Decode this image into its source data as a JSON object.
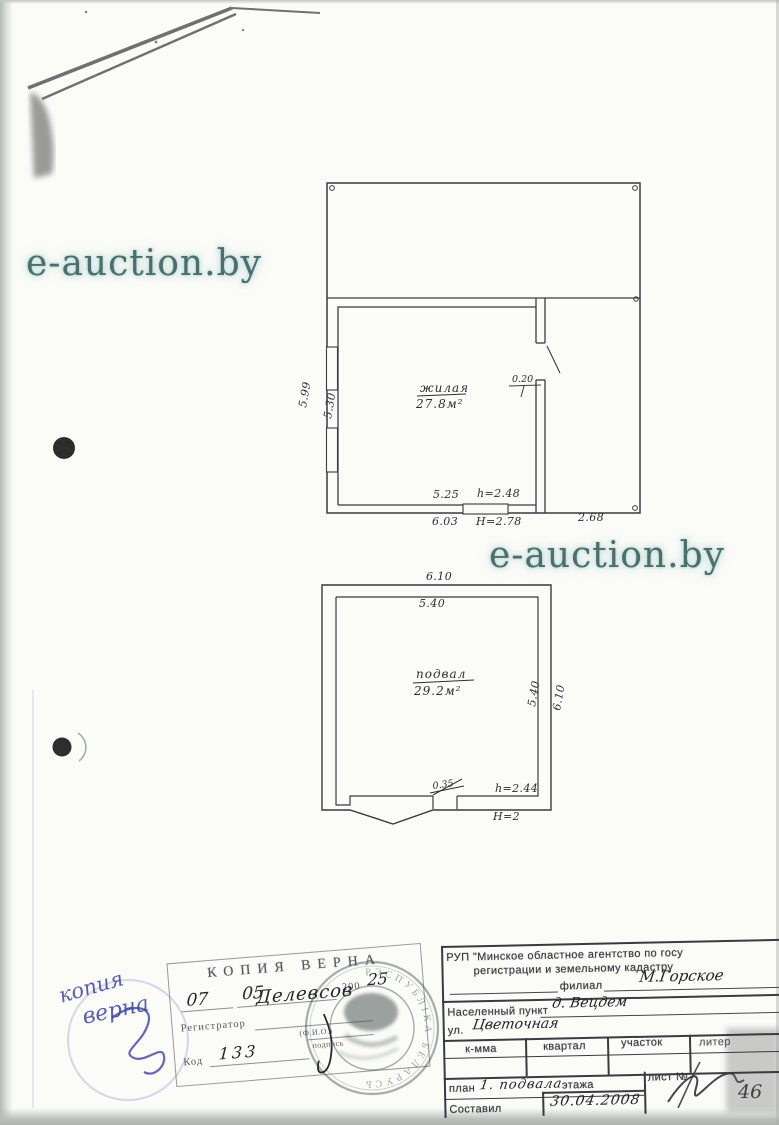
{
  "watermark": {
    "text": "e-auction.by"
  },
  "colors": {
    "watermark": "#4a6f6d",
    "ink": "#2d2d33",
    "blue_ink": "#3c43a9",
    "seal_gray": "#8f9a98"
  },
  "floor_plan_upper": {
    "room_label_line1": "жилая",
    "room_label_line2": "27.8м²",
    "dims": {
      "left_outer": "5.99",
      "left_inner": "5.30",
      "wall_right": "0.20",
      "inner_width": "5.25",
      "inner_height": "h=2.48",
      "outer_width": "6.03",
      "outer_height": "H=2.78",
      "right_width": "2.68"
    }
  },
  "floor_plan_lower": {
    "room_label_line1": "подвал",
    "room_label_line2": "29.2м²",
    "dims": {
      "top_outer": "6.10",
      "top_inner": "5.40",
      "right_inner": "5.40",
      "right_outer": "6.10",
      "door_width": "0.35",
      "inner_height": "h=2.44",
      "outer_height": "H=2"
    }
  },
  "copy_stamp": {
    "title": "КОПИЯ ВЕРНА",
    "day_hand": "07",
    "month_hand": "05",
    "year_printed": "200",
    "year_hand": "25",
    "registrar_label": "Регистратор",
    "registrar_hand": "Делевсов",
    "fio_label": "(Ф.И.О.)",
    "code_label": "Код",
    "code_hand": "133",
    "sign_label": "подпись"
  },
  "seal": {
    "ring_text": "РЭСПУБЛІКА БЕЛАРУСЬ"
  },
  "blue_note": {
    "line1": "копия",
    "line2": "верна"
  },
  "info_table": {
    "agency_line1": "РУП \"Минское областное агентство по госу",
    "agency_line2": "регистрации и земельному кадастру",
    "branch_label": "филиал",
    "branch_value": "М.Горское",
    "settlement_label": "Населенный пункт",
    "settlement_value": "д. Вецдем",
    "street_label": "ул.",
    "street_value": "Цветочная",
    "col_komma": "к-мма",
    "col_kvartal": "квартал",
    "col_uchastok": "участок",
    "col_liter": "литер",
    "plan_label": "план",
    "plan_value": "1. подвала",
    "floor_label": "этажа",
    "sheet_label": "лист №",
    "composed_label": "Составил",
    "composed_date": "30.04.2008",
    "signature_number": "46"
  }
}
